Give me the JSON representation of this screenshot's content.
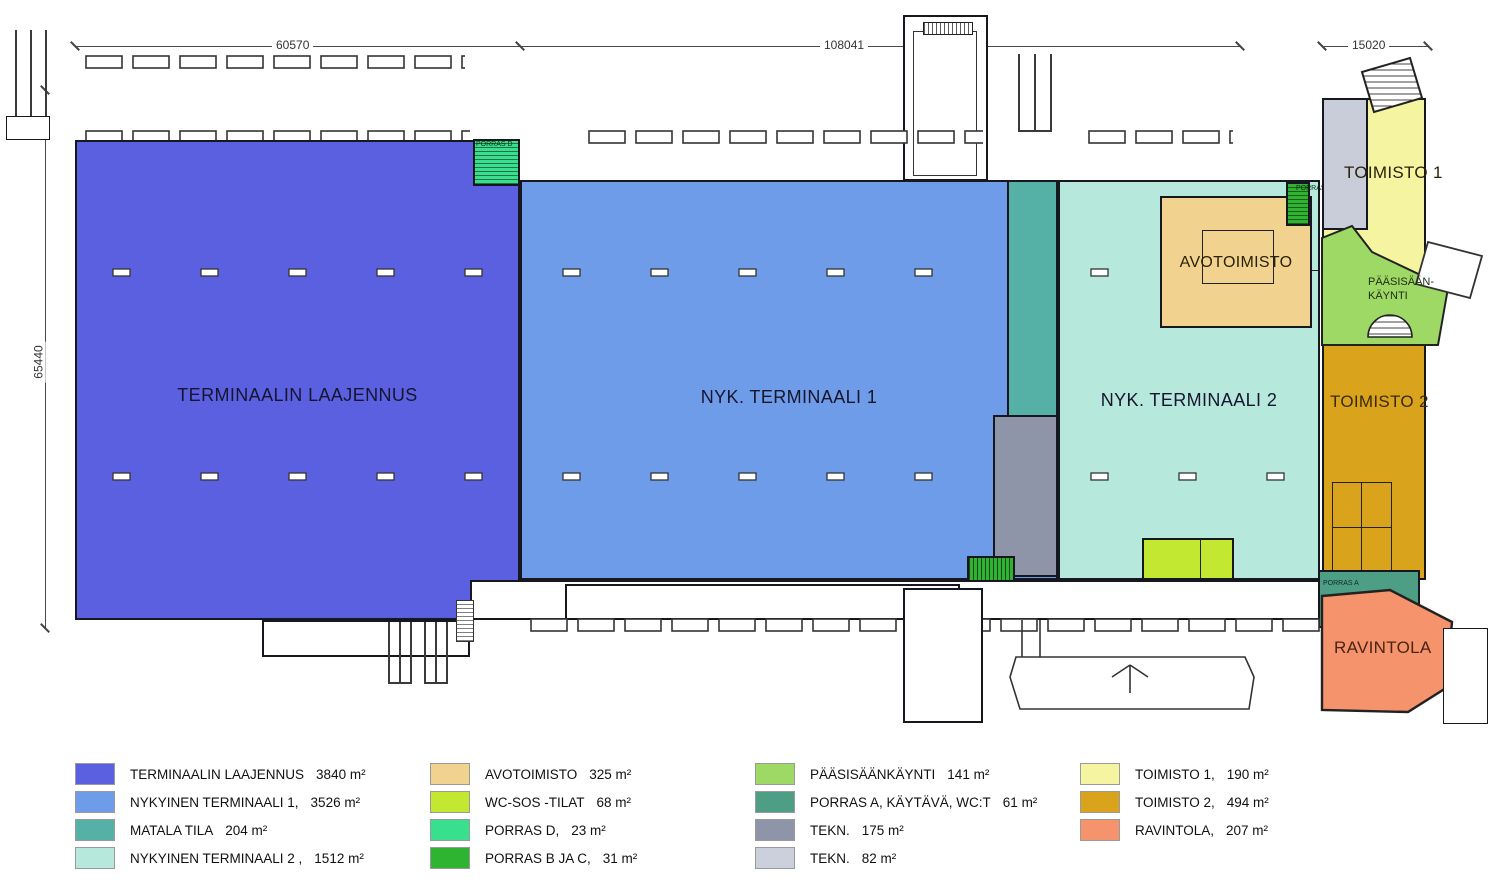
{
  "dimensions": {
    "top_left": "60570",
    "top_center": "108041",
    "top_right": "15020",
    "left_side": "65440"
  },
  "zones": {
    "laajennus": {
      "label": "TERMINAALIN LAAJENNUS",
      "color": "#5b60e1"
    },
    "terminaali1": {
      "label": "NYK. TERMINAALI 1",
      "color": "#6f9ce8"
    },
    "terminaali2": {
      "label": "NYK. TERMINAALI 2",
      "color": "#b6e9dc"
    },
    "matala": {
      "color": "#55b0a5"
    },
    "tekn_dark": {
      "color": "#8e95a8"
    },
    "tekn_light": {
      "color": "#c9cdd9"
    },
    "avotoimisto": {
      "label": "AVOTOIMISTO",
      "color": "#f2d28f"
    },
    "wc": {
      "color": "#c3e832"
    },
    "porras_d": {
      "label": "PORRAS D",
      "color": "#38e08d"
    },
    "porras_c": {
      "label": "PORRAS C",
      "color": "#2eb430"
    },
    "porras_b": {
      "label": "PORRAS B",
      "color": "#2eb430"
    },
    "porras_a": {
      "label": "PORRAS A",
      "color": "#4d9e85"
    },
    "paasisaankaynti": {
      "label_line1": "PÄÄSISÄÄN-",
      "label_line2": "KÄYNTI",
      "color": "#9ed966"
    },
    "toimisto1": {
      "label": "TOIMISTO 1",
      "color": "#f5f4a0"
    },
    "toimisto2": {
      "label": "TOIMISTO 2",
      "color": "#d9a31b"
    },
    "ravintola": {
      "label": "RAVINTOLA",
      "color": "#f4936c"
    }
  },
  "legend": {
    "columns": [
      {
        "items": [
          {
            "label": "TERMINAALIN LAAJENNUS",
            "area": "3840 m²",
            "color": "#5b60e1"
          },
          {
            "label": "NYKYINEN TERMINAALI 1,",
            "area": "3526 m²",
            "color": "#6f9ce8"
          },
          {
            "label": "MATALA TILA",
            "area": "204 m²",
            "color": "#55b0a5"
          },
          {
            "label": "NYKYINEN TERMINAALI 2 ,",
            "area": "1512 m²",
            "color": "#b6e9dc"
          }
        ]
      },
      {
        "items": [
          {
            "label": "AVOTOIMISTO",
            "area": "325 m²",
            "color": "#f2d28f"
          },
          {
            "label": "WC-SOS -TILAT",
            "area": "68 m²",
            "color": "#c3e832"
          },
          {
            "label": "PORRAS D,",
            "area": "23 m²",
            "color": "#38e08d"
          },
          {
            "label": "PORRAS B JA C,",
            "area": "31 m²",
            "color": "#2eb430"
          }
        ]
      },
      {
        "items": [
          {
            "label": "PÄÄSISÄÄNKÄYNTI",
            "area": "141 m²",
            "color": "#9ed966"
          },
          {
            "label": "PORRAS A, KÄYTÄVÄ, WC:T",
            "area": "61 m²",
            "color": "#4d9e85"
          },
          {
            "label": "TEKN.",
            "area": "175 m²",
            "color": "#8e95a8"
          },
          {
            "label": "TEKN.",
            "area": "82 m²",
            "color": "#ccd0dd"
          }
        ]
      },
      {
        "items": [
          {
            "label": "TOIMISTO 1,",
            "area": "190 m²",
            "color": "#f5f4a0"
          },
          {
            "label": "TOIMISTO 2,",
            "area": "494 m²",
            "color": "#d9a31b"
          },
          {
            "label": "RAVINTOLA,",
            "area": "207 m²",
            "color": "#f4936c"
          }
        ]
      }
    ]
  }
}
